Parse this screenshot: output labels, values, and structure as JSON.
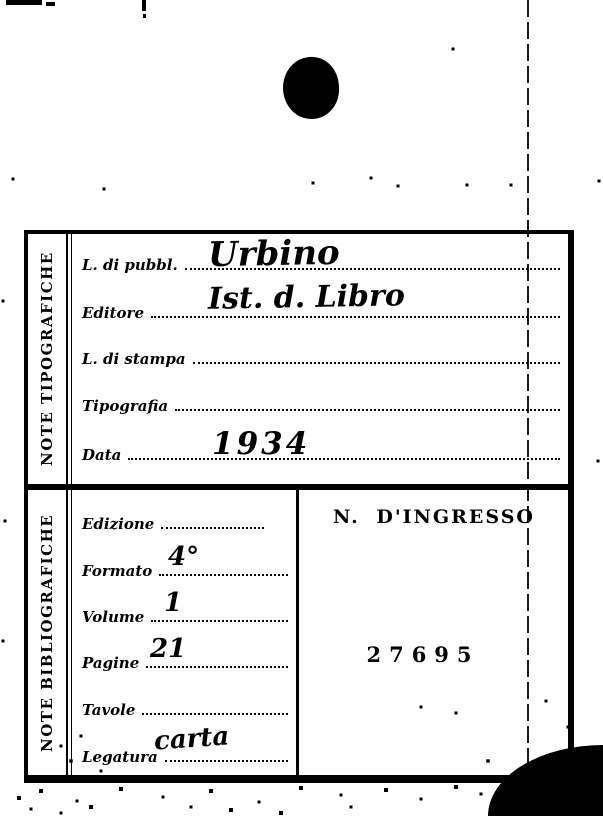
{
  "page": {
    "background": "#ffffff",
    "ink": "#000000"
  },
  "artifacts": {
    "punch_hole": "black punched hole near top center",
    "page_edge_line": "thin vertical fold line at right",
    "corner_blob": "black scanned corner bottom-right"
  },
  "card": {
    "sections": [
      {
        "sidebar_label": "NOTE TIPOGRAFICHE",
        "fields": [
          {
            "label": "L. di pubbl.",
            "value": "Urbino"
          },
          {
            "label": "Editore",
            "value": "Ist. d. Libro"
          },
          {
            "label": "L. di stampa",
            "value": ""
          },
          {
            "label": "Tipografia",
            "value": ""
          },
          {
            "label": "Data",
            "value": "1934"
          }
        ]
      },
      {
        "sidebar_label": "NOTE BIBLIOGRAFICHE",
        "fields": [
          {
            "label": "Edizione",
            "value": ""
          },
          {
            "label": "Formato",
            "value": "4°"
          },
          {
            "label": "Volume",
            "value": "1"
          },
          {
            "label": "Pagine",
            "value": "21"
          },
          {
            "label": "Tavole",
            "value": ""
          },
          {
            "label": "Legatura",
            "value": "carta"
          }
        ],
        "ingresso": {
          "label": "N. D'INGRESSO",
          "number": "27695"
        }
      }
    ]
  }
}
